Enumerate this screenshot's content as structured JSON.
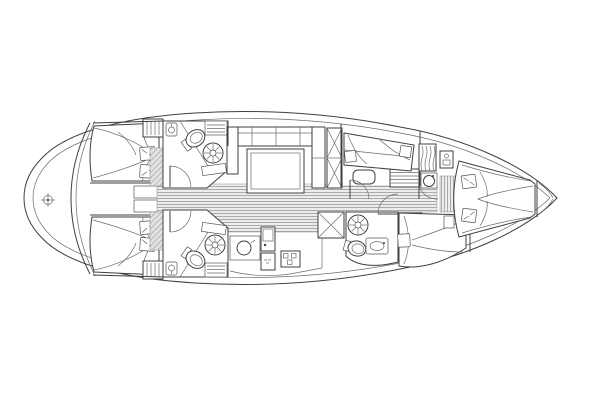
{
  "diagram": {
    "label": "Sailing yacht interior layout plan, overhead view, bow to the right",
    "type": "yacht-floor-plan",
    "orientation": {
      "bow": "right",
      "stern": "left"
    },
    "colors": {
      "background": "#ffffff",
      "line": "#3f3f3f",
      "light_line": "#6b6b6b",
      "floor_fill": "#ececec",
      "floor_stripe": "#9b9b9b",
      "hatch_fill": "#e2e2e2",
      "hatch_stripe": "#8f8f8f",
      "fixture_fill": "#ffffff"
    },
    "rooms": [
      {
        "id": "stern-platform",
        "features": [
          "transom-curve",
          "helm-compass-symbol"
        ]
      },
      {
        "id": "aft-cabin-top",
        "features": [
          "double-berth",
          "two-pillows",
          "hanging-locker"
        ]
      },
      {
        "id": "aft-cabin-bottom",
        "features": [
          "double-berth",
          "two-pillows",
          "hanging-locker"
        ]
      },
      {
        "id": "head-top",
        "features": [
          "toilet",
          "washbasin",
          "shower-fan",
          "door",
          "louvered-shelf",
          "hatched-floor"
        ]
      },
      {
        "id": "head-bottom",
        "features": [
          "toilet",
          "washbasin",
          "shower-fan",
          "door",
          "louvered-shelf",
          "hatched-floor"
        ]
      },
      {
        "id": "salon",
        "features": [
          "u-shaped-settee",
          "table",
          "wardrobe-x-locker",
          "plank-floor"
        ]
      },
      {
        "id": "galley",
        "features": [
          "round-sink",
          "stove-oven",
          "burner-hob",
          "fridge-x-box"
        ]
      },
      {
        "id": "fwd-cabin-top",
        "features": [
          "athwartships-berth",
          "two-pillows",
          "seat",
          "slatted-steps",
          "door"
        ]
      },
      {
        "id": "fwd-head-bottom",
        "features": [
          "toilet",
          "washbasin",
          "shower-fan",
          "door",
          "hatched-steps"
        ]
      },
      {
        "id": "fwd-cabin-bottom",
        "features": [
          "berth",
          "pillow",
          "side-table"
        ]
      },
      {
        "id": "bow-cabin",
        "features": [
          "v-berth",
          "two-pillows",
          "vanity-sink",
          "hanging-locker",
          "water-heater",
          "plank-floor"
        ]
      }
    ]
  }
}
